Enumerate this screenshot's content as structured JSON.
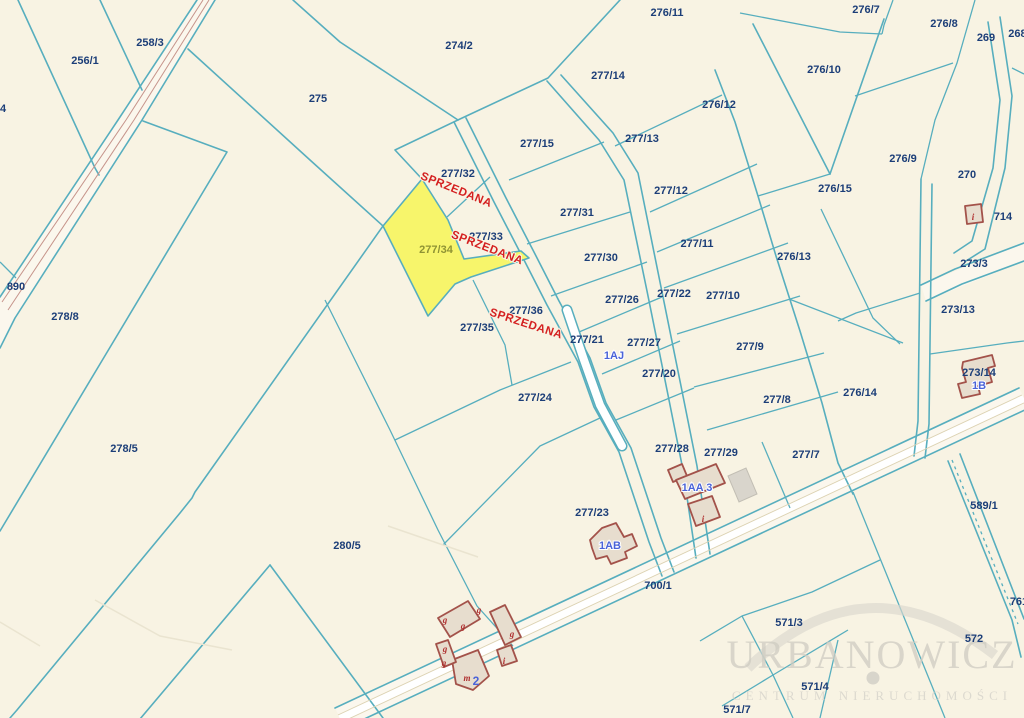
{
  "colors": {
    "background": "#f8f3e3",
    "boundary": "#57aebe",
    "parcel_label": "#1c3e78",
    "sold_parcel_fill": "#f7f56b",
    "sold_parcel_label": "#8f9334",
    "sold_text_color": "#d42020",
    "address_label": "#4a63d8",
    "building_outline": "#a3524a",
    "road_inner_line": "#c6948b"
  },
  "parcels": {
    "p256_1": "256/1",
    "p258_3": "258/3",
    "p274_2": "274/2",
    "p275": "275",
    "p276_11": "276/11",
    "p276_7": "276/7",
    "p276_8": "276/8",
    "p269": "269",
    "p268": "268/",
    "p277_14": "277/14",
    "p276_10": "276/10",
    "p276_12": "276/12",
    "p277_15": "277/15",
    "p277_13": "277/13",
    "p276_9": "276/9",
    "p270": "270",
    "p276_15": "276/15",
    "p277_32": "277/32",
    "p277_12": "277/12",
    "p277_31": "277/31",
    "p277_33": "277/33",
    "p277_34": "277/34",
    "p277_30": "277/30",
    "p277_11": "277/11",
    "p276_13": "276/13",
    "p714": "714",
    "p890": "890",
    "p278_8": "278/8",
    "p273_3": "273/3",
    "p277_26": "277/26",
    "p277_22": "277/22",
    "p277_10": "277/10",
    "p273_13": "273/13",
    "p277_36": "277/36",
    "p277_35": "277/35",
    "p277_21": "277/21",
    "p277_27": "277/27",
    "p277_9": "277/9",
    "p277_20": "277/20",
    "p273_14": "273/14",
    "p276_14": "276/14",
    "p278_5": "278/5",
    "p277_24": "277/24",
    "p277_8": "277/8",
    "p277_28": "277/28",
    "p277_29": "277/29",
    "p277_7": "277/7",
    "p277_23": "277/23",
    "p589_1": "589/1",
    "p280_5": "280/5",
    "p700_1": "700/1",
    "p761": "761",
    "p571_3": "571/3",
    "p572": "572",
    "p571_4": "571/4",
    "p571_7": "571/7",
    "p4": "4"
  },
  "sold_text": "SPRZEDANA",
  "addresses": {
    "a1aj": "1AJ",
    "a1b": "1B",
    "a1aa": "1AA 3",
    "a1ab": "1AB"
  },
  "building_marks": {
    "g": "g",
    "i": "i",
    "m": "m",
    "two": "2"
  },
  "watermark": {
    "title": "URBANOWICZ",
    "subtitle": "CENTRUM NIERUCHOMOŚCI"
  }
}
